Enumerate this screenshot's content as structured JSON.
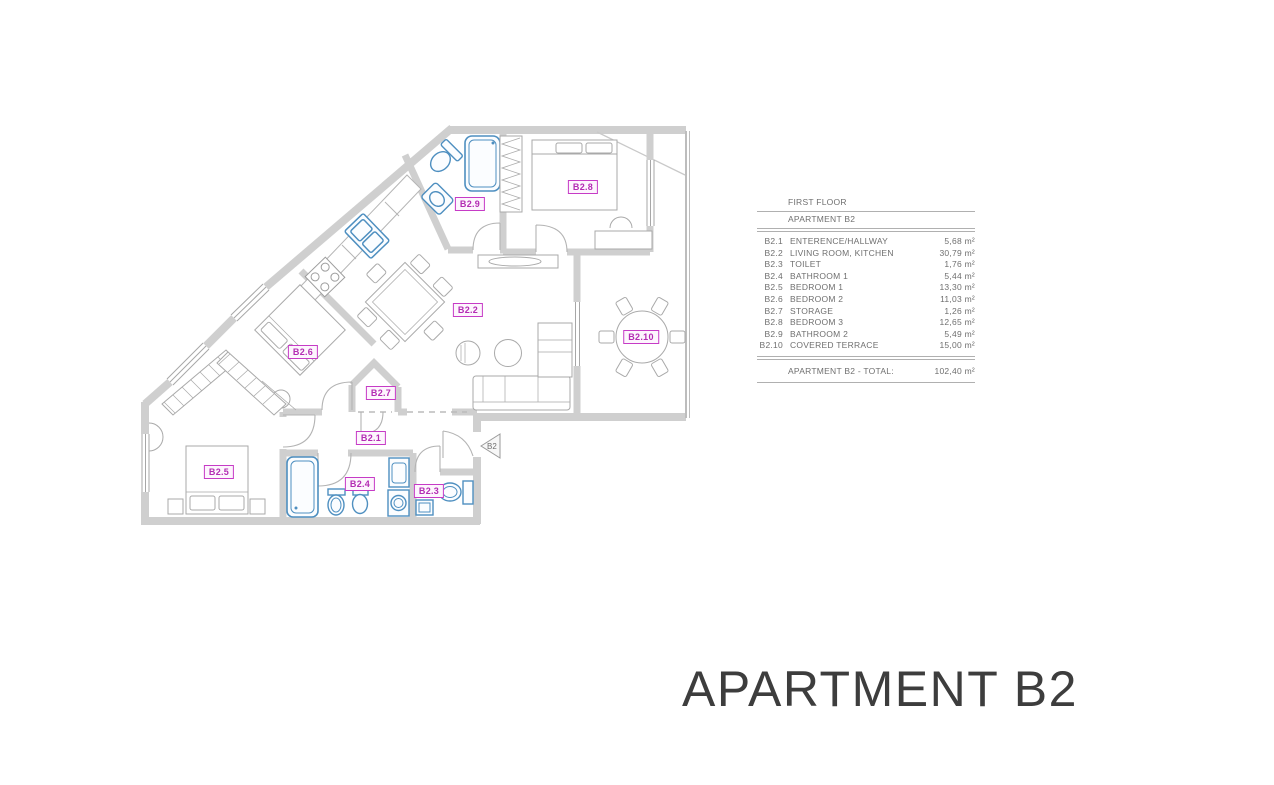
{
  "plan": {
    "entrance_marker": "B2",
    "rooms": [
      {
        "code": "B2.1",
        "x": 371,
        "y": 438
      },
      {
        "code": "B2.2",
        "x": 468,
        "y": 310
      },
      {
        "code": "B2.3",
        "x": 429,
        "y": 491
      },
      {
        "code": "B2.4",
        "x": 360,
        "y": 484
      },
      {
        "code": "B2.5",
        "x": 219,
        "y": 472
      },
      {
        "code": "B2.6",
        "x": 303,
        "y": 352
      },
      {
        "code": "B2.7",
        "x": 381,
        "y": 393
      },
      {
        "code": "B2.8",
        "x": 583,
        "y": 187
      },
      {
        "code": "B2.9",
        "x": 470,
        "y": 204
      },
      {
        "code": "B2.10",
        "x": 641,
        "y": 337
      }
    ],
    "colors": {
      "label_magenta": "#c63bc6",
      "fixture_blue": "#4e8fc0",
      "wall_gray": "#cfcfcf"
    }
  },
  "legend": {
    "floor_title": "FIRST FLOOR",
    "apartment_title": "APARTMENT B2",
    "rows": [
      {
        "code": "B2.1",
        "name": "ENTERENCE/HALLWAY",
        "area": "5,68 m²"
      },
      {
        "code": "B2.2",
        "name": "LIVING ROOM, KITCHEN",
        "area": "30,79 m²"
      },
      {
        "code": "B2.3",
        "name": "TOILET",
        "area": "1,76 m²"
      },
      {
        "code": "B2.4",
        "name": "BATHROOM 1",
        "area": "5,44 m²"
      },
      {
        "code": "B2.5",
        "name": "BEDROOM 1",
        "area": "13,30 m²"
      },
      {
        "code": "B2.6",
        "name": "BEDROOM 2",
        "area": "11,03 m²"
      },
      {
        "code": "B2.7",
        "name": "STORAGE",
        "area": "1,26 m²"
      },
      {
        "code": "B2.8",
        "name": "BEDROOM 3",
        "area": "12,65 m²"
      },
      {
        "code": "B2.9",
        "name": "BATHROOM 2",
        "area": "5,49 m²"
      },
      {
        "code": "B2.10",
        "name": "COVERED TERRACE",
        "area": "15,00 m²"
      }
    ],
    "total_label": "APARTMENT B2 - TOTAL:",
    "total_area": "102,40 m²"
  },
  "title": "APARTMENT B2"
}
